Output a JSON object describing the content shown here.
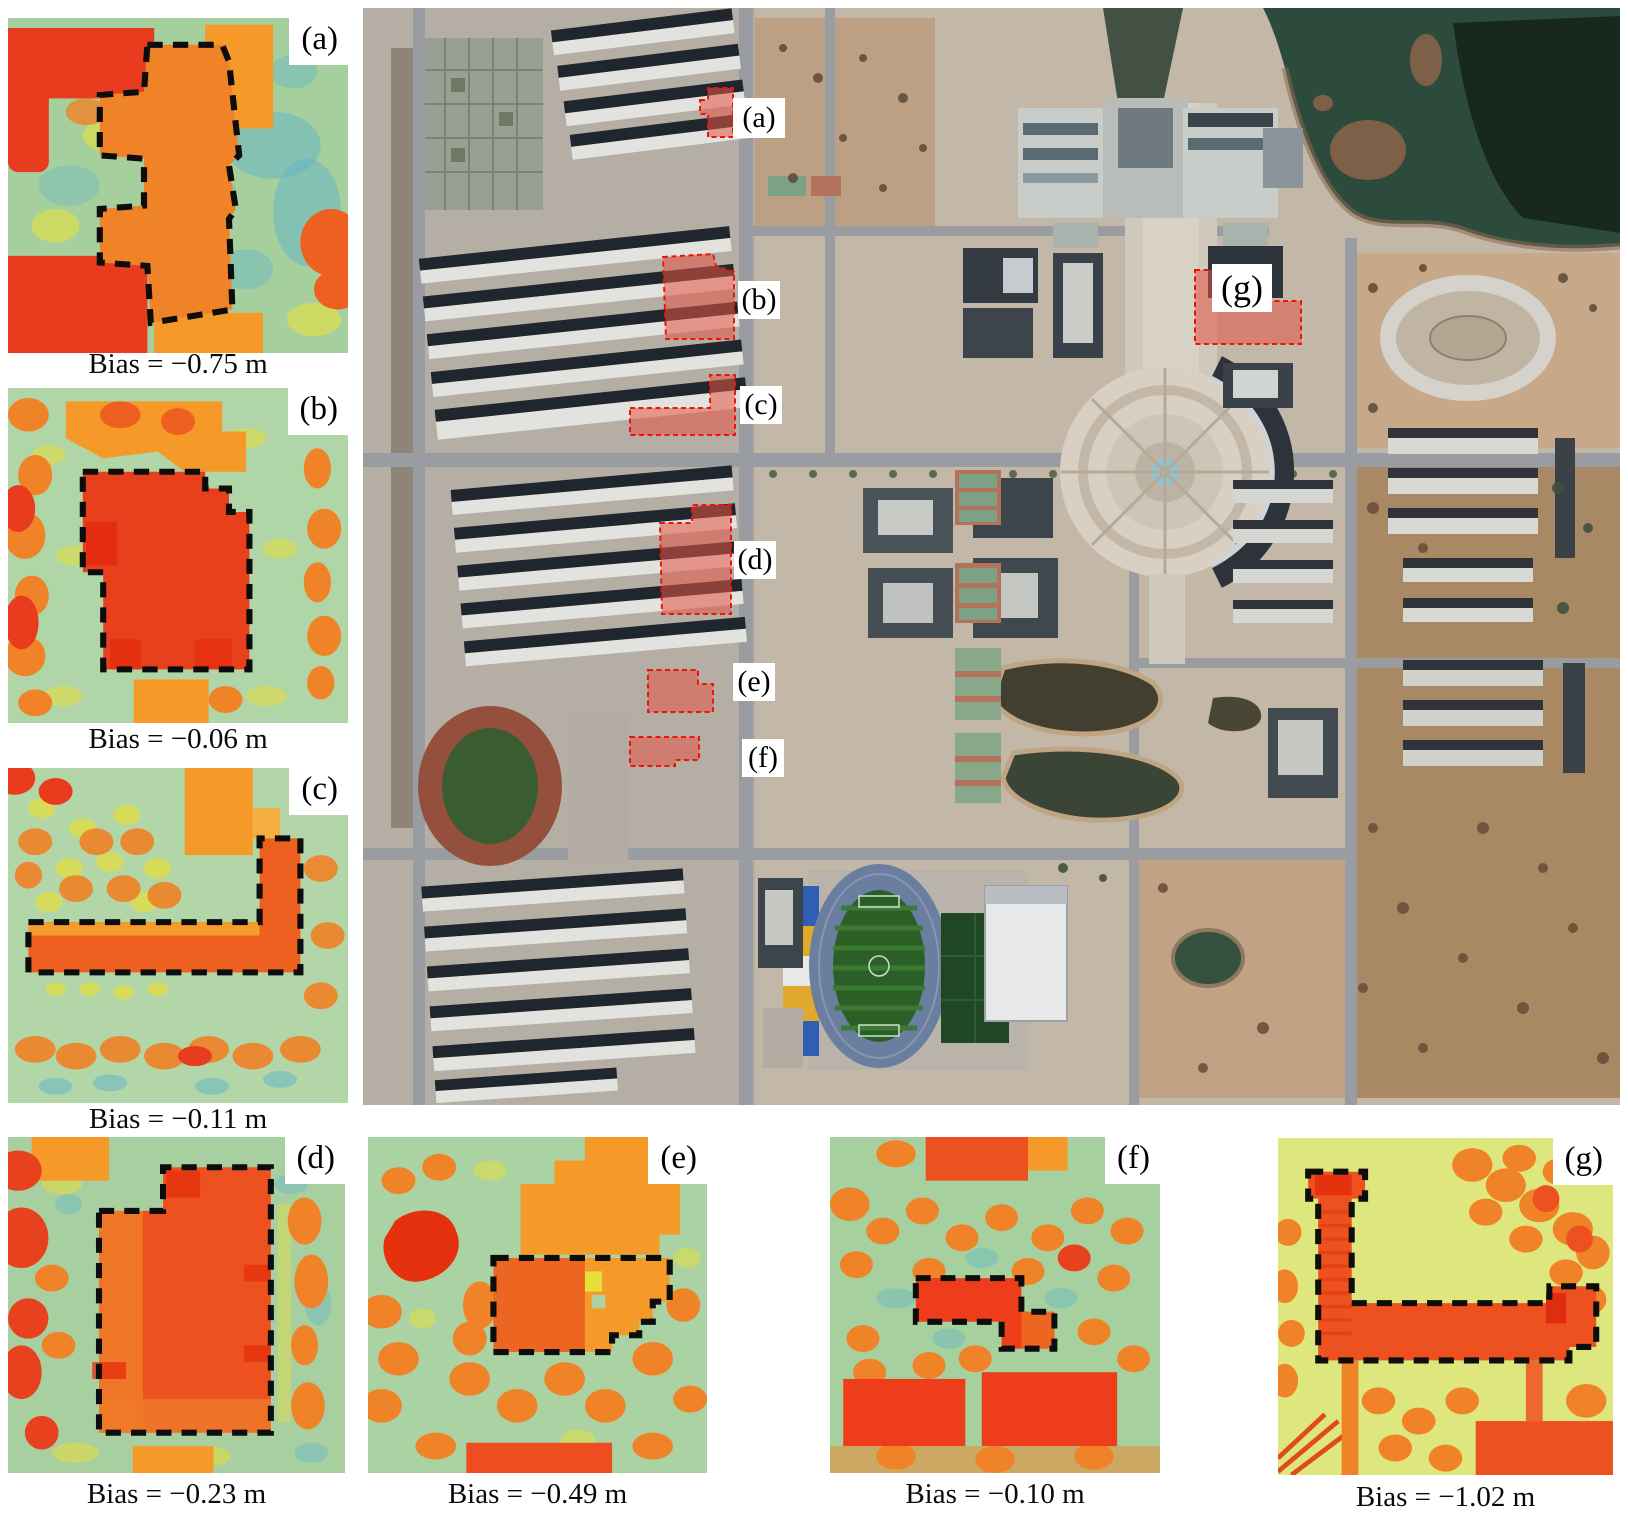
{
  "panels": [
    {
      "id": "a",
      "label": "(a)",
      "caption": "Bias = −0.75 m"
    },
    {
      "id": "b",
      "label": "(b)",
      "caption": "Bias = −0.06 m"
    },
    {
      "id": "c",
      "label": "(c)",
      "caption": "Bias = −0.11 m"
    },
    {
      "id": "d",
      "label": "(d)",
      "caption": "Bias = −0.23 m"
    },
    {
      "id": "e",
      "label": "(e)",
      "caption": "Bias = −0.49 m"
    },
    {
      "id": "f",
      "label": "(f)",
      "caption": "Bias = −0.10 m"
    },
    {
      "id": "g",
      "label": "(g)",
      "caption": "Bias = −1.02 m"
    }
  ],
  "map": {
    "markers": [
      {
        "id": "a",
        "label": "(a)"
      },
      {
        "id": "b",
        "label": "(b)"
      },
      {
        "id": "c",
        "label": "(c)"
      },
      {
        "id": "d",
        "label": "(d)"
      },
      {
        "id": "e",
        "label": "(e)"
      },
      {
        "id": "f",
        "label": "(f)"
      },
      {
        "id": "g",
        "label": "(g)"
      }
    ]
  },
  "colors": {
    "heat_teal": "#5fb3c8",
    "heat_green": "#aad2a2",
    "heat_yellow": "#e6df3a",
    "heat_orange": "#f59a28",
    "heat_deep_orange": "#ee5f22",
    "heat_red": "#e93b1e",
    "highlight_fill": "#e45545",
    "highlight_stroke": "#ee1508",
    "water": "#2d4b3d",
    "field_green": "#2c5f27",
    "track_blue": "#6a7fa0"
  }
}
